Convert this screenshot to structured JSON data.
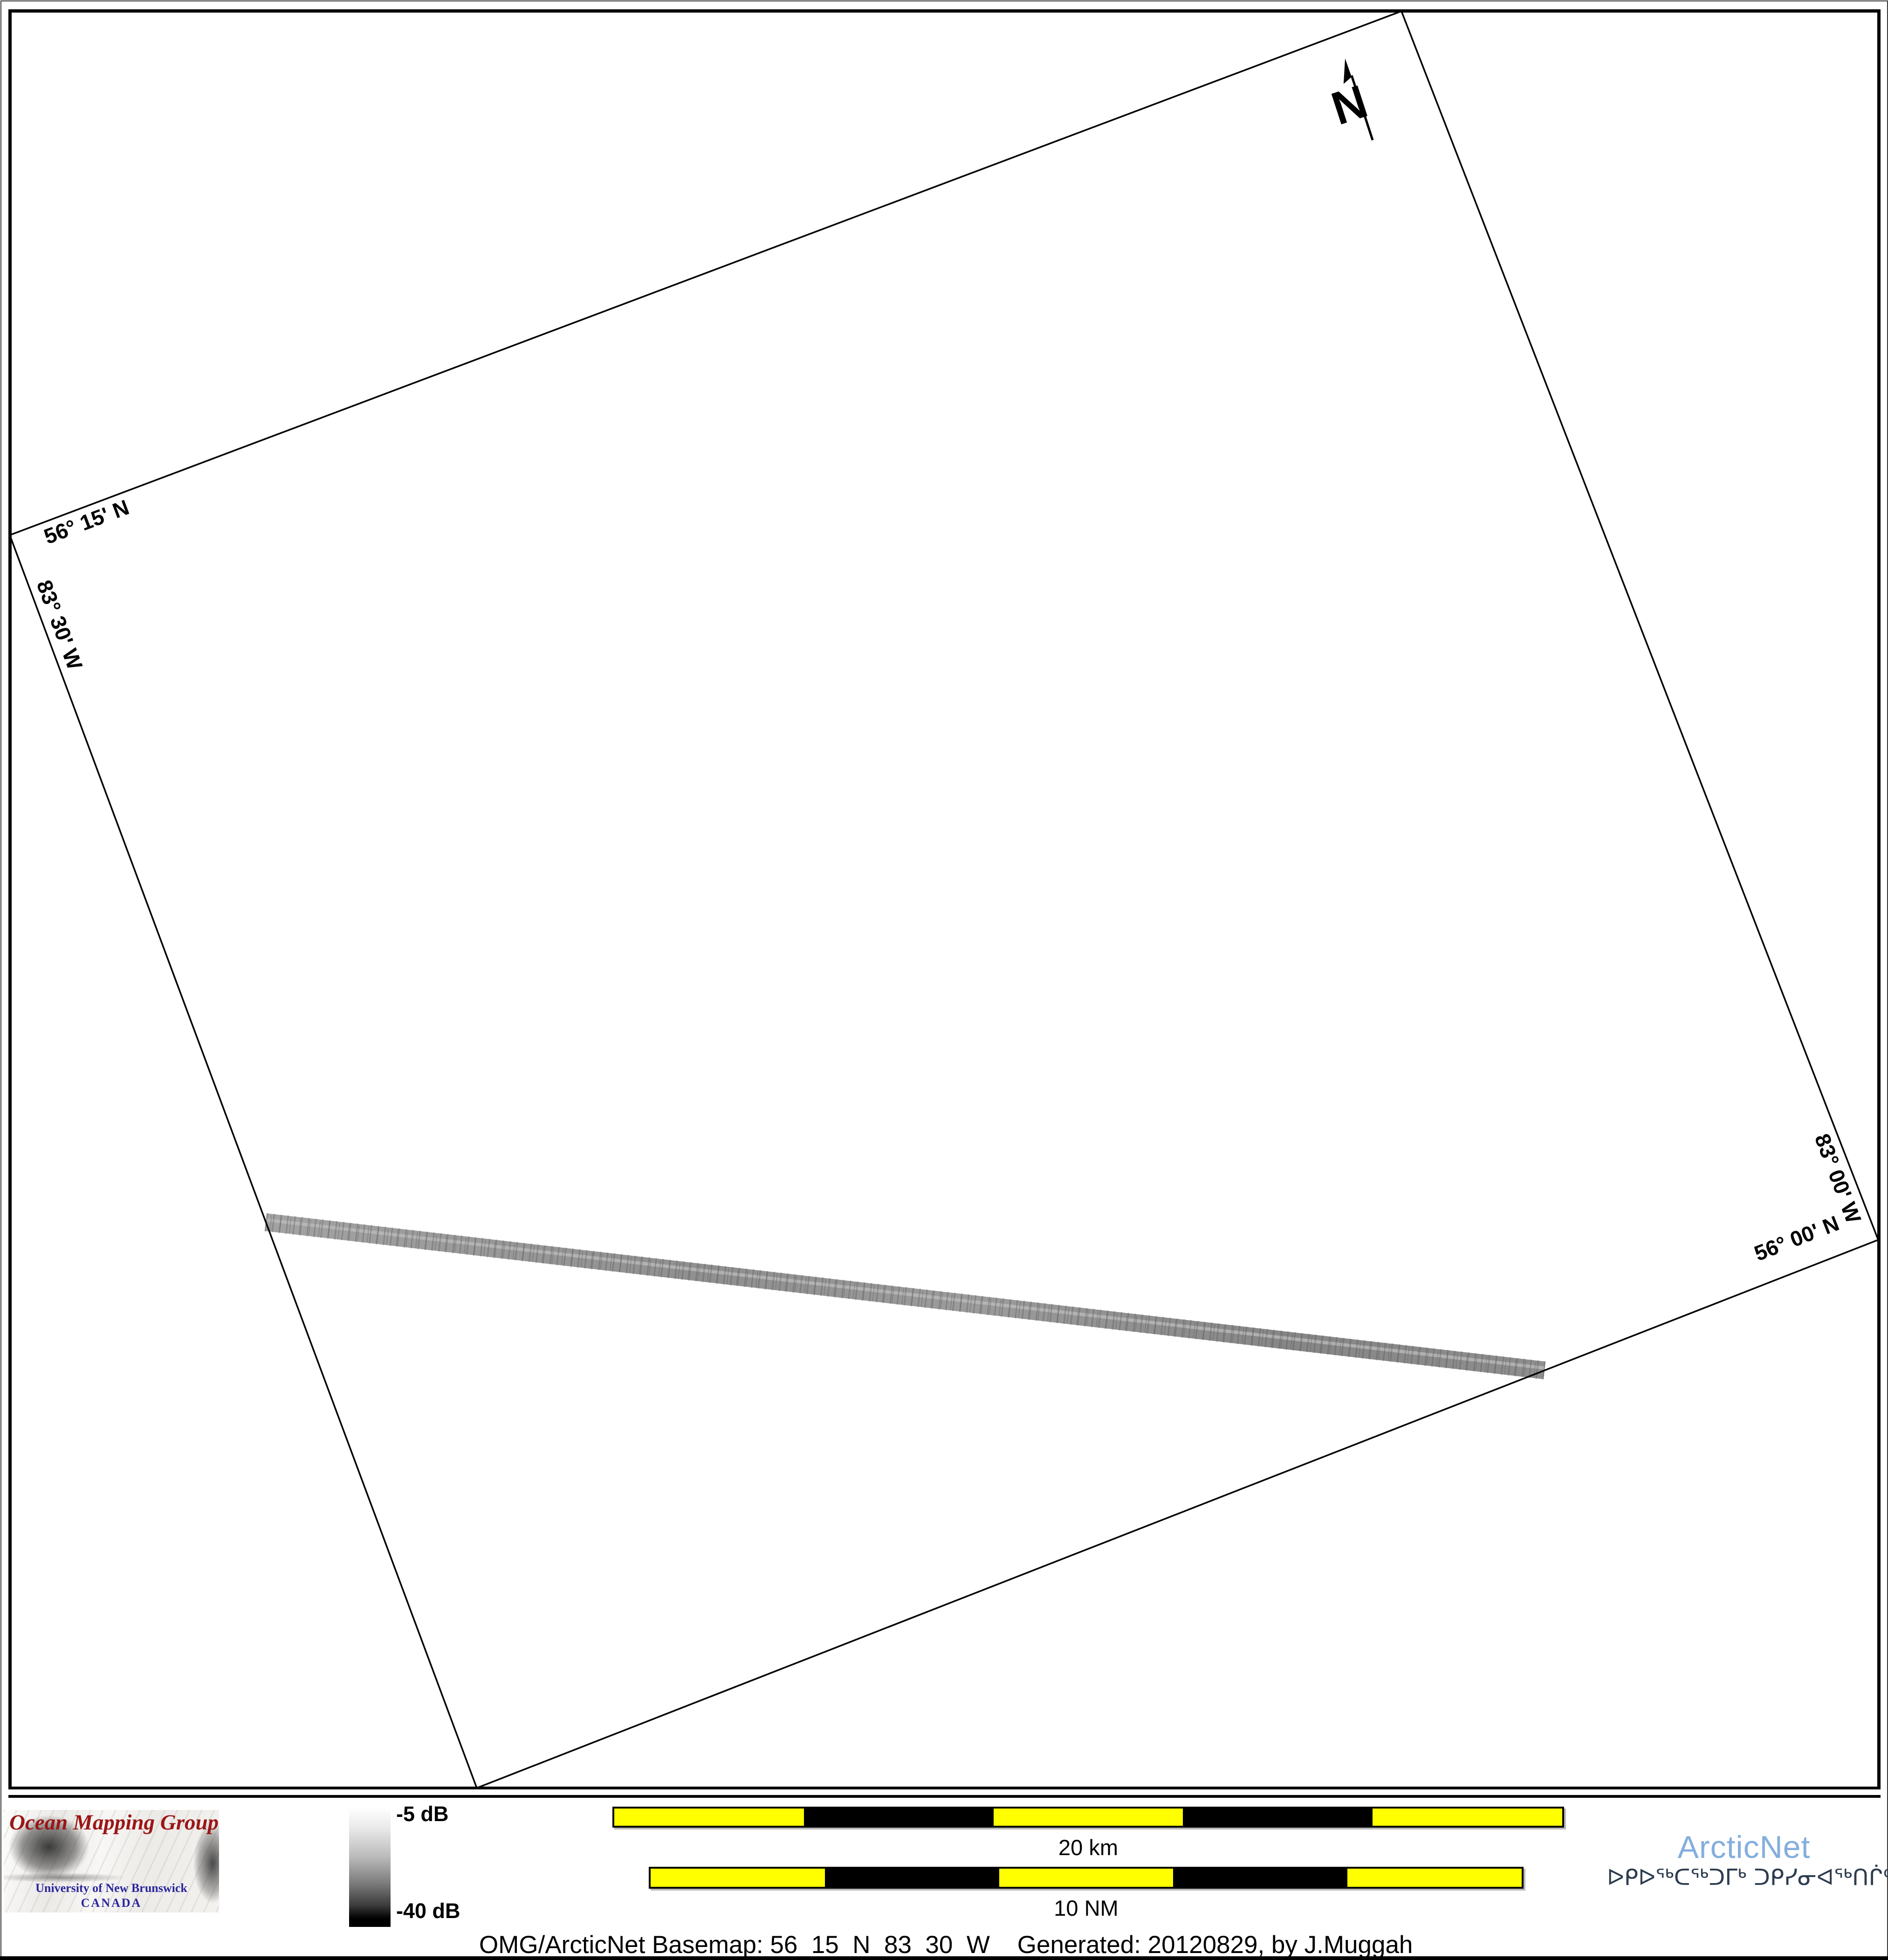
{
  "map": {
    "labels": {
      "lat_top": "56° 15' N",
      "lon_left": "83° 30' W",
      "lon_right": "83° 00' W",
      "lat_bottom": "56° 00' N"
    },
    "north_arrow": "N"
  },
  "colorbar": {
    "max": "-5 dB",
    "min": "-40 dB"
  },
  "scalebars": {
    "km": {
      "label": "20 km",
      "total": "20 km",
      "segments": [
        "yellow",
        "black",
        "yellow",
        "black",
        "yellow"
      ]
    },
    "nm": {
      "label": "10 NM",
      "total": "10 NM",
      "segments": [
        "yellow",
        "black",
        "yellow",
        "black",
        "yellow"
      ]
    }
  },
  "logos": {
    "omg": {
      "title": "Ocean Mapping Group",
      "subtitle": "University of New Brunswick",
      "country": "CANADA"
    },
    "arcticnet": {
      "name": "ArcticNet",
      "inuktitut": "ᐅᑭᐅᖅᑕᖅᑐᒥᒃ ᑐᑭᓯᓂᐊᖅᑎᒌᑦ"
    }
  },
  "caption": "OMG/ArcticNet Basemap: 56_15_N_83_30_W    Generated: 20120829, by J.Muggah",
  "colors": {
    "scalebar_yellow": "#ffff00",
    "scalebar_black": "#000000",
    "omg_red": "#9b1616",
    "unb_blue": "#29259e",
    "arcticnet_blue": "#84aedd",
    "inuktitut_navy": "#2d3c50",
    "swath_gray": "#949494",
    "boundary_black": "#000000"
  }
}
